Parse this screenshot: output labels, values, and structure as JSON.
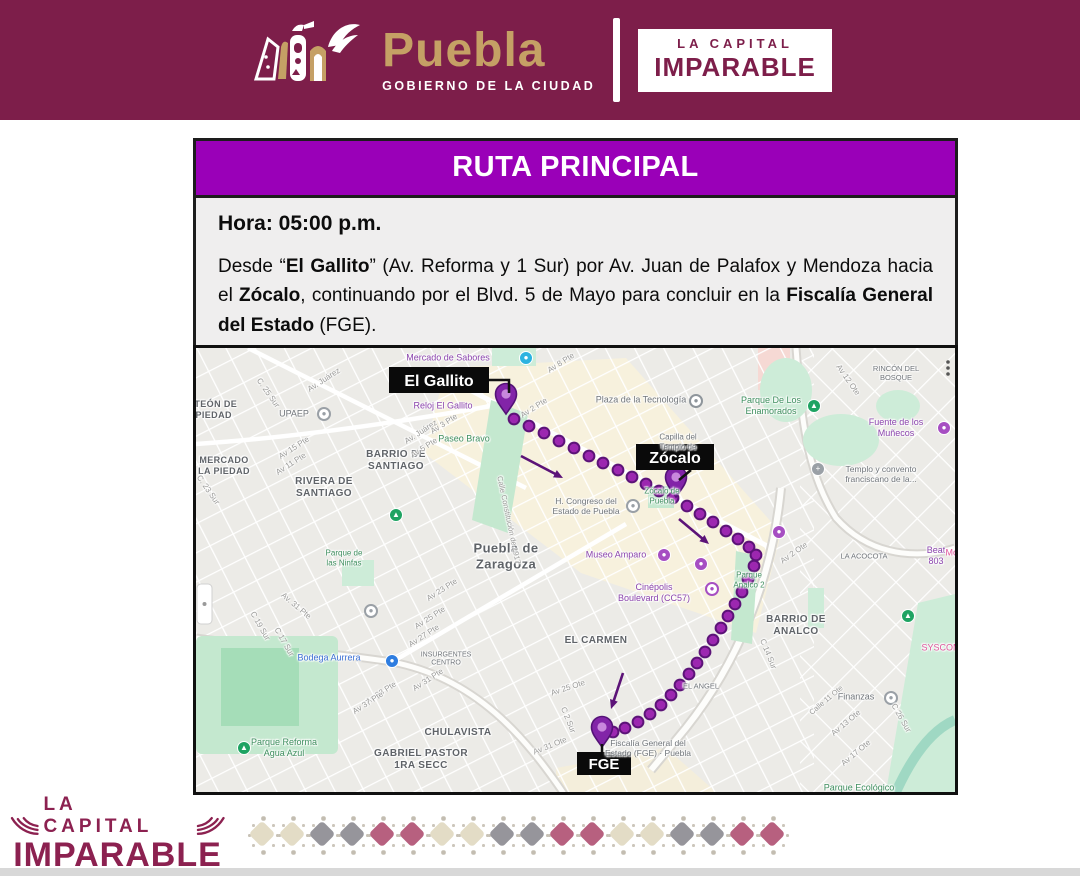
{
  "colors": {
    "maroon": "#7d1e4a",
    "title_purple": "#9a00b8",
    "brand_tan": "#c5a065",
    "route_purple": "#9c27b0",
    "route_dark": "#5c1378",
    "card_bg": "#efeeee",
    "pattern_cream": "#e3dcc6",
    "pattern_gray": "#96959b",
    "pattern_rose": "#b7607f"
  },
  "header": {
    "logo_text": "Puebla",
    "logo_subtext": "GOBIERNO DE LA CIUDAD",
    "badge_line1": "LA CAPITAL",
    "badge_line2": "IMPARABLE"
  },
  "route_card": {
    "title": "RUTA PRINCIPAL",
    "time_label": "Hora: 05:00 p.m.",
    "description_parts": [
      {
        "t": "Desde “"
      },
      {
        "t": "El Gallito",
        "b": true
      },
      {
        "t": "” (Av. Reforma y 1 Sur) por Av. Juan de Palafox y Mendoza hacia el "
      },
      {
        "t": "Zócalo",
        "b": true
      },
      {
        "t": ", continuando por el Blvd. 5 de Mayo para concluir en la "
      },
      {
        "t": "Fiscalía General del Estado",
        "b": true
      },
      {
        "t": " (FGE)."
      }
    ]
  },
  "map": {
    "callouts": [
      {
        "t": "El Gallito",
        "x": 193,
        "y": 19,
        "w": 100,
        "h": 26,
        "fs": 16,
        "line": [
          [
            293,
            32
          ],
          [
            313,
            32
          ],
          [
            313,
            45
          ]
        ]
      },
      {
        "t": "Zócalo",
        "x": 440,
        "y": 96,
        "w": 78,
        "h": 26,
        "fs": 16,
        "line": [
          [
            495,
            122
          ],
          [
            483,
            132
          ]
        ]
      },
      {
        "t": "FGE",
        "x": 381,
        "y": 404,
        "w": 54,
        "h": 23,
        "fs": 15,
        "line": [
          [
            406,
            396
          ],
          [
            406,
            404
          ]
        ]
      }
    ],
    "markers": [
      {
        "name": "El Gallito",
        "x": 310,
        "y": 48
      },
      {
        "name": "Zócalo",
        "x": 480,
        "y": 131
      },
      {
        "name": "FGE",
        "x": 406,
        "y": 381
      }
    ],
    "route": {
      "dots": [
        [
          318,
          71
        ],
        [
          333,
          78
        ],
        [
          348,
          85
        ],
        [
          363,
          93
        ],
        [
          378,
          100
        ],
        [
          393,
          108
        ],
        [
          407,
          115
        ],
        [
          422,
          122
        ],
        [
          436,
          129
        ],
        [
          450,
          136
        ],
        [
          463,
          143
        ],
        [
          477,
          150
        ],
        [
          491,
          158
        ],
        [
          504,
          166
        ],
        [
          517,
          174
        ],
        [
          530,
          183
        ],
        [
          542,
          191
        ],
        [
          553,
          199
        ],
        [
          560,
          207
        ],
        [
          558,
          218
        ],
        [
          552,
          231
        ],
        [
          546,
          244
        ],
        [
          539,
          256
        ],
        [
          532,
          268
        ],
        [
          525,
          280
        ],
        [
          517,
          292
        ],
        [
          509,
          304
        ],
        [
          501,
          315
        ],
        [
          493,
          326
        ],
        [
          484,
          337
        ],
        [
          475,
          347
        ],
        [
          465,
          357
        ],
        [
          454,
          366
        ],
        [
          442,
          374
        ],
        [
          429,
          380
        ],
        [
          417,
          384
        ]
      ],
      "arrows": [
        {
          "x1": 325,
          "y1": 108,
          "x2": 367,
          "y2": 130
        },
        {
          "x1": 483,
          "y1": 171,
          "x2": 513,
          "y2": 196
        },
        {
          "x1": 427,
          "y1": 325,
          "x2": 415,
          "y2": 361
        }
      ]
    },
    "icons": [
      {
        "x": 330,
        "y": 10,
        "c": "#2bb3e0",
        "g": "●"
      },
      {
        "x": 128,
        "y": 66,
        "c": "#9aa0a6",
        "g": "●",
        "ring": 1
      },
      {
        "x": 500,
        "y": 53,
        "c": "#8e959b",
        "g": "●",
        "ring": 1
      },
      {
        "x": 618,
        "y": 58,
        "c": "#1ea362",
        "g": "▲"
      },
      {
        "x": 748,
        "y": 80,
        "c": "#a64ec2",
        "g": "●"
      },
      {
        "x": 622,
        "y": 121,
        "c": "#9aa0a6",
        "g": "+"
      },
      {
        "x": 437,
        "y": 158,
        "c": "#9aa0a6",
        "g": "●",
        "ring": 1
      },
      {
        "x": 468,
        "y": 207,
        "c": "#a64ec2",
        "g": "●"
      },
      {
        "x": 505,
        "y": 216,
        "c": "#a64ec2",
        "g": "●"
      },
      {
        "x": 583,
        "y": 184,
        "c": "#a64ec2",
        "g": "●"
      },
      {
        "x": 516,
        "y": 241,
        "c": "#a64ec2",
        "g": "●",
        "ring": 1
      },
      {
        "x": 695,
        "y": 350,
        "c": "#9aa0a6",
        "g": "●",
        "ring": 1
      },
      {
        "x": 712,
        "y": 268,
        "c": "#1ea362",
        "g": "▲"
      },
      {
        "x": 196,
        "y": 313,
        "c": "#2e7de0",
        "g": "●"
      },
      {
        "x": 48,
        "y": 400,
        "c": "#1ea362",
        "g": "▲"
      },
      {
        "x": 200,
        "y": 167,
        "c": "#1ea362",
        "g": "▲"
      },
      {
        "x": 175,
        "y": 263,
        "c": "#9aa0a6",
        "g": "●",
        "ring": 1
      }
    ],
    "labels": [
      {
        "t": "Mercado de Sabores",
        "x": 252,
        "y": 10,
        "c": "p",
        "s": 9
      },
      {
        "t": "Reloj El Gallito",
        "x": 247,
        "y": 58,
        "c": "p",
        "s": 9
      },
      {
        "t": "Paseo Bravo",
        "x": 268,
        "y": 91,
        "c": "gr",
        "s": 9
      },
      {
        "t": "PANTEÓN DE\nLA PIEDAD",
        "x": 10,
        "y": 62,
        "c": "a",
        "s": 9,
        "b": 1
      },
      {
        "t": "MERCADO\nLA PIEDAD",
        "x": 28,
        "y": 118,
        "c": "a",
        "s": 9,
        "b": 1
      },
      {
        "t": "UPAEP",
        "x": 98,
        "y": 66,
        "c": "g",
        "s": 9
      },
      {
        "t": "BARRIO DE\nSANTIAGO",
        "x": 200,
        "y": 113,
        "c": "a",
        "s": 10,
        "b": 1
      },
      {
        "t": "RIVERA DE\nSANTIAGO",
        "x": 128,
        "y": 140,
        "c": "a",
        "s": 10,
        "b": 1
      },
      {
        "t": "Puebla de\nZaragoza",
        "x": 310,
        "y": 208,
        "c": "a",
        "s": 13,
        "b": 1
      },
      {
        "t": "H. Congreso del\nEstado de Puebla",
        "x": 390,
        "y": 158,
        "c": "g",
        "s": 8.5
      },
      {
        "t": "Plaza de la Tecnología",
        "x": 445,
        "y": 52,
        "c": "g",
        "s": 9
      },
      {
        "t": "Capilla del\nTemplo de",
        "x": 482,
        "y": 94,
        "c": "g",
        "s": 8
      },
      {
        "t": "Zócalo de\nPuebla",
        "x": 466,
        "y": 148,
        "c": "gr",
        "s": 8
      },
      {
        "t": "Parque De Los\nEnamorados",
        "x": 575,
        "y": 58,
        "c": "gr",
        "s": 9
      },
      {
        "t": "Fuente de los Muñecos",
        "x": 700,
        "y": 80,
        "c": "p",
        "s": 9
      },
      {
        "t": "Templo y convento\nfranciscano de la...",
        "x": 685,
        "y": 126,
        "c": "g",
        "s": 8.5
      },
      {
        "t": "Museo Amparo",
        "x": 420,
        "y": 207,
        "c": "p",
        "s": 9
      },
      {
        "t": "Cinépolis\nBoulevard (CC57)",
        "x": 458,
        "y": 245,
        "c": "p",
        "s": 9
      },
      {
        "t": "Parque\nAnalco 2",
        "x": 553,
        "y": 232,
        "c": "gr",
        "s": 8
      },
      {
        "t": "BARRIO DE\nANALCO",
        "x": 600,
        "y": 278,
        "c": "a",
        "s": 10,
        "b": 1
      },
      {
        "t": "EL CARMEN",
        "x": 400,
        "y": 293,
        "c": "a",
        "s": 10,
        "b": 1
      },
      {
        "t": "EL ANGEL",
        "x": 505,
        "y": 338,
        "c": "g",
        "s": 7.5
      },
      {
        "t": "Finanzas",
        "x": 660,
        "y": 349,
        "c": "g",
        "s": 9
      },
      {
        "t": "LA ACOCOTA",
        "x": 668,
        "y": 208,
        "c": "g",
        "s": 7.5
      },
      {
        "t": "Beat 803",
        "x": 740,
        "y": 208,
        "c": "p",
        "s": 9
      },
      {
        "t": "RINCÓN DEL\nBOSQUE",
        "x": 700,
        "y": 25,
        "c": "g",
        "s": 7.5
      },
      {
        "t": "SYSCOM",
        "x": 745,
        "y": 300,
        "c": "pk",
        "s": 9
      },
      {
        "t": "Mot",
        "x": 757,
        "y": 205,
        "c": "pk",
        "s": 9
      },
      {
        "t": "Parque Ecológico",
        "x": 663,
        "y": 440,
        "c": "gr",
        "s": 9
      },
      {
        "t": "Fiscalía General del\nEstado (FGE) · Puebla",
        "x": 452,
        "y": 400,
        "c": "g",
        "s": 8.5
      },
      {
        "t": "CHULAVISTA",
        "x": 262,
        "y": 385,
        "c": "a",
        "s": 10,
        "b": 1
      },
      {
        "t": "GABRIEL PASTOR\n1RA SECC",
        "x": 225,
        "y": 412,
        "c": "a",
        "s": 10,
        "b": 1
      },
      {
        "t": "Parque Reforma\nAgua Azul",
        "x": 88,
        "y": 400,
        "c": "gr",
        "s": 9
      },
      {
        "t": "Bodega Aurrera",
        "x": 133,
        "y": 310,
        "c": "bl",
        "s": 9
      },
      {
        "t": "INSURGENTES\nCENTRO",
        "x": 250,
        "y": 312,
        "c": "g",
        "s": 7
      },
      {
        "t": "Parque de\nlas Ninfas",
        "x": 148,
        "y": 210,
        "c": "gr",
        "s": 8
      },
      {
        "t": "Av. Juárez",
        "x": 128,
        "y": 32,
        "c": "st",
        "s": 8,
        "r": -33
      },
      {
        "t": "Av. Juárez",
        "x": 225,
        "y": 84,
        "c": "st",
        "s": 8,
        "r": -33
      },
      {
        "t": "C. 25 Sur",
        "x": 72,
        "y": 45,
        "c": "st",
        "s": 8,
        "r": 55
      },
      {
        "t": "C. 23 Sur",
        "x": 12,
        "y": 142,
        "c": "st",
        "s": 8,
        "r": 55
      },
      {
        "t": "Av 15 Pte",
        "x": 98,
        "y": 100,
        "c": "st",
        "s": 8,
        "r": -33
      },
      {
        "t": "Av 11 Pte",
        "x": 95,
        "y": 116,
        "c": "st",
        "s": 8,
        "r": -33
      },
      {
        "t": "Av 3 Pte",
        "x": 248,
        "y": 76,
        "c": "st",
        "s": 8,
        "r": -33
      },
      {
        "t": "Av 5 Pte",
        "x": 228,
        "y": 100,
        "c": "st",
        "s": 8,
        "r": -33
      },
      {
        "t": "Av 2 Pte",
        "x": 338,
        "y": 60,
        "c": "st",
        "s": 8,
        "r": -33
      },
      {
        "t": "Av 8 Pte",
        "x": 365,
        "y": 15,
        "c": "st",
        "s": 8,
        "r": -33
      },
      {
        "t": "Calle Constitución de 1917",
        "x": 313,
        "y": 172,
        "c": "st",
        "s": 7.5,
        "r": 78
      },
      {
        "t": "Av 23 Pte",
        "x": 246,
        "y": 242,
        "c": "st",
        "s": 8,
        "r": -33
      },
      {
        "t": "Av 25 Pte",
        "x": 234,
        "y": 270,
        "c": "st",
        "s": 8,
        "r": -33
      },
      {
        "t": "Av 27 Pte",
        "x": 228,
        "y": 288,
        "c": "st",
        "s": 8,
        "r": -33
      },
      {
        "t": "Av 31 Pte",
        "x": 232,
        "y": 332,
        "c": "st",
        "s": 8,
        "r": -33
      },
      {
        "t": "Av 33 Pte",
        "x": 185,
        "y": 345,
        "c": "st",
        "s": 8,
        "r": -33
      },
      {
        "t": "Av 37 Pte",
        "x": 172,
        "y": 355,
        "c": "st",
        "s": 8,
        "r": -33
      },
      {
        "t": "C 19 Sur",
        "x": 64,
        "y": 278,
        "c": "st",
        "s": 8,
        "r": 60
      },
      {
        "t": "C 17 Sur",
        "x": 88,
        "y": 294,
        "c": "st",
        "s": 8,
        "r": 60
      },
      {
        "t": "Av. 31 Pte",
        "x": 100,
        "y": 258,
        "c": "st",
        "s": 8,
        "r": 40
      },
      {
        "t": "Av 25 Ote",
        "x": 372,
        "y": 340,
        "c": "st",
        "s": 8,
        "r": -18
      },
      {
        "t": "Av 31 Ote",
        "x": 354,
        "y": 398,
        "c": "st",
        "s": 8,
        "r": -22
      },
      {
        "t": "C 2 Sur",
        "x": 372,
        "y": 372,
        "c": "st",
        "s": 8,
        "r": 68
      },
      {
        "t": "C 14 Sur",
        "x": 572,
        "y": 306,
        "c": "st",
        "s": 8,
        "r": 68
      },
      {
        "t": "C 26 Sur",
        "x": 705,
        "y": 370,
        "c": "st",
        "s": 8,
        "r": 60
      },
      {
        "t": "Calle 11 Ote",
        "x": 630,
        "y": 352,
        "c": "st",
        "s": 7.5,
        "r": -40
      },
      {
        "t": "Av 13 Ote",
        "x": 650,
        "y": 375,
        "c": "st",
        "s": 8,
        "r": -40
      },
      {
        "t": "Av 17 Ote",
        "x": 660,
        "y": 405,
        "c": "st",
        "s": 8,
        "r": -40
      },
      {
        "t": "Av 12 Ote",
        "x": 652,
        "y": 32,
        "c": "st",
        "s": 8,
        "r": 55
      },
      {
        "t": "Av 2 Ote",
        "x": 598,
        "y": 205,
        "c": "st",
        "s": 8,
        "r": -35
      }
    ]
  },
  "footer": {
    "logo_line1": "LA CAPITAL",
    "logo_line2": "IMPARABLE",
    "pattern": [
      "cream",
      "cream",
      "gray",
      "gray",
      "rose",
      "rose",
      "cream",
      "cream",
      "gray",
      "gray",
      "rose",
      "rose",
      "cream",
      "cream",
      "gray",
      "gray",
      "rose",
      "rose"
    ]
  }
}
